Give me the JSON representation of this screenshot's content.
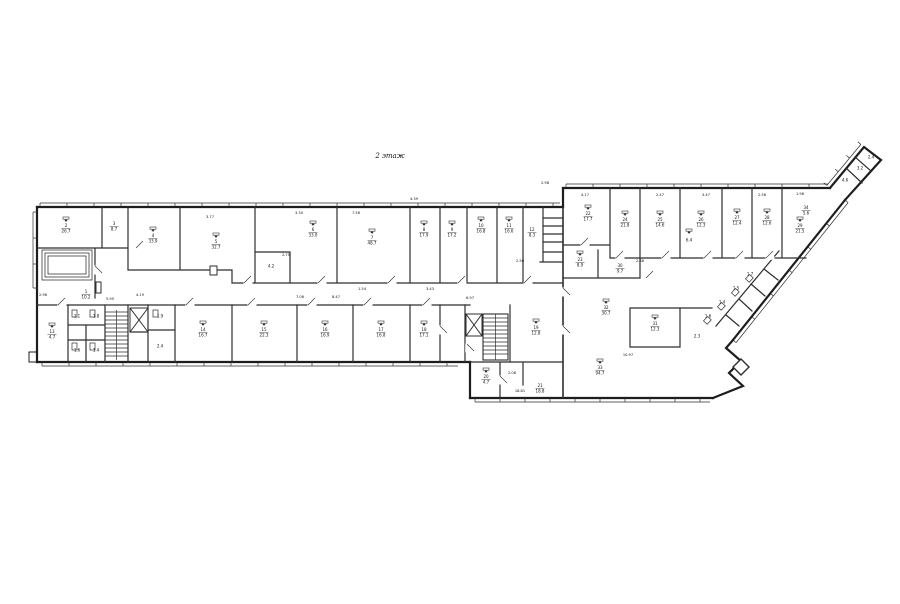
{
  "page": {
    "background": "#ffffff"
  },
  "drawing": {
    "title": "2 этаж",
    "line_color": "#2a2a2a",
    "room_labels": [
      {
        "n": "2",
        "a": "26.7",
        "x": 66,
        "y": 228,
        "d": 1
      },
      {
        "n": "3",
        "a": "8.7",
        "x": 114,
        "y": 226,
        "d": 0
      },
      {
        "n": "4",
        "a": "33.9",
        "x": 153,
        "y": 238,
        "d": 1
      },
      {
        "n": "5",
        "a": "32.7",
        "x": 216,
        "y": 244,
        "d": 1
      },
      {
        "n": "6",
        "a": "33.0",
        "x": 313,
        "y": 232,
        "d": 1
      },
      {
        "n": "",
        "a": "4.2",
        "x": 271,
        "y": 266,
        "d": 0
      },
      {
        "n": "7",
        "a": "48.7",
        "x": 372,
        "y": 240,
        "d": 1
      },
      {
        "n": "8",
        "a": "17.9",
        "x": 424,
        "y": 232,
        "d": 1
      },
      {
        "n": "9",
        "a": "17.2",
        "x": 452,
        "y": 232,
        "d": 1
      },
      {
        "n": "10",
        "a": "16.8",
        "x": 481,
        "y": 228,
        "d": 1
      },
      {
        "n": "11",
        "a": "16.6",
        "x": 509,
        "y": 228,
        "d": 1
      },
      {
        "n": "12",
        "a": "8.3",
        "x": 532,
        "y": 232,
        "d": 0
      },
      {
        "n": "1",
        "a": "10.2",
        "x": 86,
        "y": 294,
        "d": 0
      },
      {
        "n": "13",
        "a": "4.7",
        "x": 52,
        "y": 334,
        "d": 1
      },
      {
        "n": "",
        "a": "2.1",
        "x": 77,
        "y": 316,
        "d": 0
      },
      {
        "n": "",
        "a": "1.8",
        "x": 96,
        "y": 316,
        "d": 0
      },
      {
        "n": "",
        "a": "1.6",
        "x": 77,
        "y": 350,
        "d": 0
      },
      {
        "n": "",
        "a": "1.4",
        "x": 96,
        "y": 350,
        "d": 0
      },
      {
        "n": "",
        "a": "1.9",
        "x": 160,
        "y": 316,
        "d": 0
      },
      {
        "n": "",
        "a": "2.4",
        "x": 160,
        "y": 346,
        "d": 0
      },
      {
        "n": "14",
        "a": "16.7",
        "x": 203,
        "y": 332,
        "d": 1
      },
      {
        "n": "15",
        "a": "22.3",
        "x": 264,
        "y": 332,
        "d": 1
      },
      {
        "n": "16",
        "a": "16.9",
        "x": 325,
        "y": 332,
        "d": 1
      },
      {
        "n": "17",
        "a": "16.8",
        "x": 381,
        "y": 332,
        "d": 1
      },
      {
        "n": "18",
        "a": "17.1",
        "x": 424,
        "y": 332,
        "d": 1
      },
      {
        "n": "19",
        "a": "12.8",
        "x": 536,
        "y": 330,
        "d": 1
      },
      {
        "n": "20",
        "a": "4.7",
        "x": 486,
        "y": 379,
        "d": 1
      },
      {
        "n": "21",
        "a": "18.8",
        "x": 540,
        "y": 388,
        "d": 0
      },
      {
        "n": "22",
        "a": "17.7",
        "x": 588,
        "y": 216,
        "d": 1
      },
      {
        "n": "23",
        "a": "8.9",
        "x": 580,
        "y": 262,
        "d": 1
      },
      {
        "n": "24",
        "a": "21.8",
        "x": 625,
        "y": 222,
        "d": 1
      },
      {
        "n": "25",
        "a": "14.6",
        "x": 660,
        "y": 222,
        "d": 1
      },
      {
        "n": "26",
        "a": "12.3",
        "x": 701,
        "y": 222,
        "d": 1
      },
      {
        "n": "27",
        "a": "12.4",
        "x": 737,
        "y": 220,
        "d": 1
      },
      {
        "n": "28",
        "a": "12.6",
        "x": 767,
        "y": 220,
        "d": 1
      },
      {
        "n": "29",
        "a": "21.5",
        "x": 800,
        "y": 228,
        "d": 1
      },
      {
        "n": "30",
        "a": "9.7",
        "x": 620,
        "y": 268,
        "d": 0
      },
      {
        "n": "31",
        "a": "12.3",
        "x": 655,
        "y": 326,
        "d": 1
      },
      {
        "n": "32",
        "a": "30.7",
        "x": 606,
        "y": 310,
        "d": 1
      },
      {
        "n": "33",
        "a": "94.7",
        "x": 600,
        "y": 370,
        "d": 1
      },
      {
        "n": "",
        "a": "6.4",
        "x": 689,
        "y": 240,
        "d": 1
      },
      {
        "n": "",
        "a": "1.6",
        "x": 708,
        "y": 316,
        "d": 0
      },
      {
        "n": "",
        "a": "1.4",
        "x": 722,
        "y": 302,
        "d": 0
      },
      {
        "n": "",
        "a": "1.5",
        "x": 736,
        "y": 288,
        "d": 0
      },
      {
        "n": "",
        "a": "1.7",
        "x": 750,
        "y": 274,
        "d": 0
      },
      {
        "n": "",
        "a": "2.3",
        "x": 697,
        "y": 336,
        "d": 0
      },
      {
        "n": "34",
        "a": "5.6",
        "x": 806,
        "y": 210,
        "d": 0
      },
      {
        "n": "",
        "a": "4.6",
        "x": 845,
        "y": 180,
        "d": 0
      },
      {
        "n": "",
        "a": "3.2",
        "x": 860,
        "y": 168,
        "d": 0
      },
      {
        "n": "",
        "a": "2.4",
        "x": 871,
        "y": 157,
        "d": 0
      }
    ],
    "dim_labels": [
      {
        "t": "4.39",
        "x": 414,
        "y": 200
      },
      {
        "t": "2.98",
        "x": 545,
        "y": 184
      },
      {
        "t": "3.30",
        "x": 299,
        "y": 214
      },
      {
        "t": "7.56",
        "x": 356,
        "y": 214
      },
      {
        "t": "2.75",
        "x": 286,
        "y": 256
      },
      {
        "t": "3.77",
        "x": 210,
        "y": 218
      },
      {
        "t": "6.97",
        "x": 470,
        "y": 299
      },
      {
        "t": "7.06",
        "x": 300,
        "y": 298
      },
      {
        "t": "8.47",
        "x": 336,
        "y": 298
      },
      {
        "t": "1.54",
        "x": 362,
        "y": 290
      },
      {
        "t": "10.97",
        "x": 628,
        "y": 356
      },
      {
        "t": "18.81",
        "x": 520,
        "y": 392
      },
      {
        "t": "2.08",
        "x": 512,
        "y": 374
      },
      {
        "t": "5.95",
        "x": 110,
        "y": 300
      },
      {
        "t": "4.17",
        "x": 585,
        "y": 196
      },
      {
        "t": "2.47",
        "x": 660,
        "y": 196
      },
      {
        "t": "3.47",
        "x": 706,
        "y": 196
      },
      {
        "t": "2.56",
        "x": 762,
        "y": 196
      },
      {
        "t": "1.98",
        "x": 800,
        "y": 195
      },
      {
        "t": "2.96",
        "x": 43,
        "y": 296
      },
      {
        "t": "4.19",
        "x": 140,
        "y": 296
      },
      {
        "t": "2.88",
        "x": 640,
        "y": 262
      },
      {
        "t": "3.43",
        "x": 430,
        "y": 290
      },
      {
        "t": "2.56",
        "x": 520,
        "y": 262
      }
    ]
  }
}
